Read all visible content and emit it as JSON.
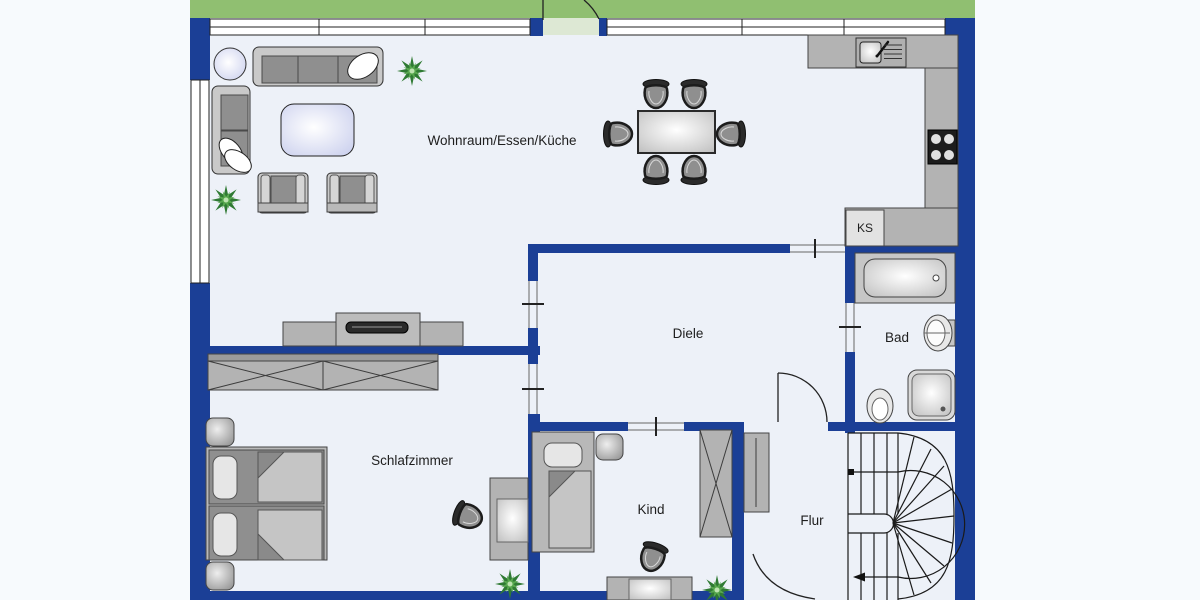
{
  "rooms": {
    "living": "Wohnraum/Essen/Küche",
    "hallway": "Diele",
    "bath": "Bad",
    "bedroom": "Schlafzimmer",
    "child": "Kind",
    "corridor": "Flur",
    "fridge": "KS"
  },
  "colors": {
    "wall": "#1b3f96",
    "garden": "#90bf71",
    "floor": "#edf1f8",
    "outside": "#f7fafd",
    "furniture": "#b3b3b3",
    "accent_table": "#ccd1ee"
  }
}
